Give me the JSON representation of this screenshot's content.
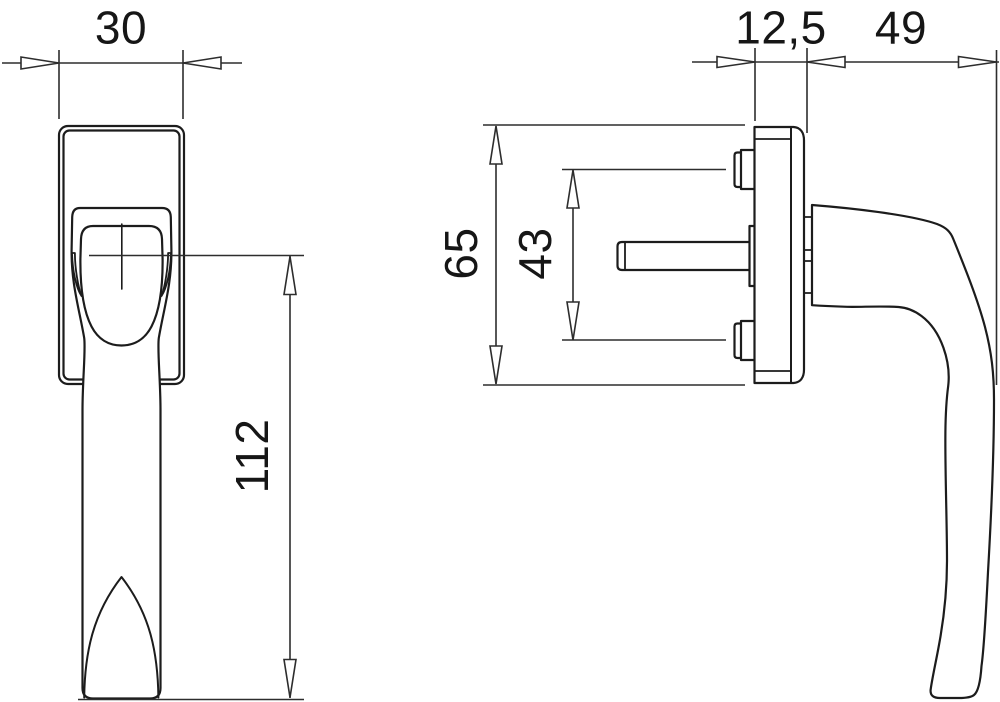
{
  "drawing": {
    "kind": "technical dimension drawing",
    "subject": "window handle, front view and side view",
    "units": "mm",
    "colors": {
      "background": "#ffffff",
      "object_line": "#1c1c1c",
      "dimension_line": "#2d2d2d",
      "text": "#161616"
    },
    "labels": {
      "handle_width": "30",
      "handle_length": "112",
      "plate_depth": "12,5",
      "handle_depth": "49",
      "plate_height": "65",
      "screw_spacing": "43"
    }
  }
}
